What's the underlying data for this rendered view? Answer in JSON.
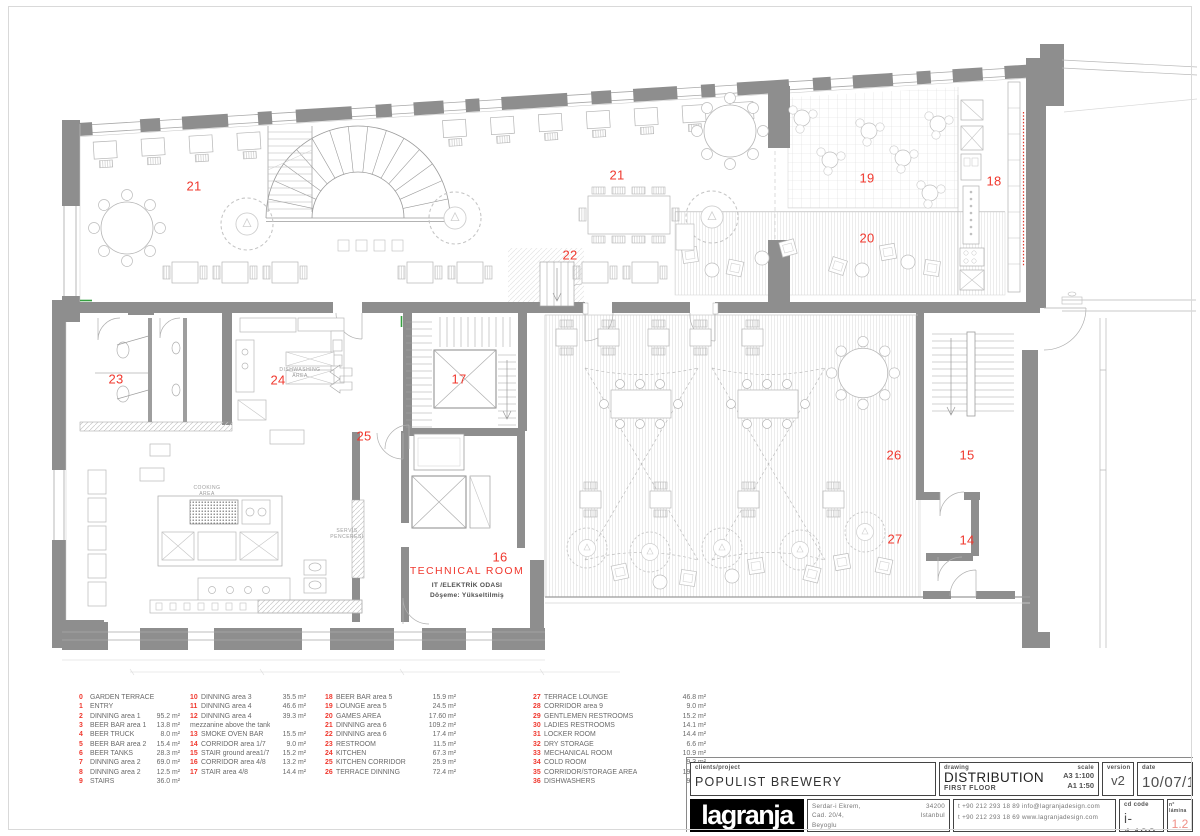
{
  "colors": {
    "accent_red": "#f0382e",
    "wall_gray": "#8e8e8e",
    "lamina_red": "#ef8f86"
  },
  "plan": {
    "labels": [
      {
        "n": "21",
        "x": 194,
        "y": 186
      },
      {
        "n": "21",
        "x": 617,
        "y": 175
      },
      {
        "n": "19",
        "x": 867,
        "y": 178
      },
      {
        "n": "18",
        "x": 994,
        "y": 181
      },
      {
        "n": "20",
        "x": 867,
        "y": 238
      },
      {
        "n": "22",
        "x": 570,
        "y": 255
      },
      {
        "n": "23",
        "x": 116,
        "y": 379
      },
      {
        "n": "24",
        "x": 278,
        "y": 380
      },
      {
        "n": "17",
        "x": 459,
        "y": 379
      },
      {
        "n": "25",
        "x": 364,
        "y": 436
      },
      {
        "n": "26",
        "x": 894,
        "y": 455
      },
      {
        "n": "15",
        "x": 967,
        "y": 455
      },
      {
        "n": "27",
        "x": 895,
        "y": 539
      },
      {
        "n": "14",
        "x": 967,
        "y": 540
      },
      {
        "n": "16",
        "x": 500,
        "y": 557
      }
    ],
    "area_texts": [
      {
        "t": "DISHWASHING",
        "x": 300,
        "y": 370
      },
      {
        "t": "AREA",
        "x": 300,
        "y": 376
      },
      {
        "t": "COOKING",
        "x": 207,
        "y": 488
      },
      {
        "t": "AREA",
        "x": 207,
        "y": 494
      },
      {
        "t": "SERVİS",
        "x": 347,
        "y": 531
      },
      {
        "t": "PENCERESİ",
        "x": 347,
        "y": 537
      }
    ],
    "technical_room": {
      "title": "TECHNICAL ROOM",
      "line1": "IT /ELEKTRİK ODASI",
      "line2": "Döşeme: Yükseltilmiş"
    }
  },
  "legend": {
    "columns": [
      {
        "x": 79,
        "width": 101,
        "items": [
          {
            "n": "0",
            "label": "GARDEN TERRACE",
            "area": ""
          },
          {
            "n": "1",
            "label": "ENTRY",
            "area": ""
          },
          {
            "n": "2",
            "label": "DINNING area 1",
            "area": "95.2 m²"
          },
          {
            "n": "3",
            "label": "BEER BAR area 1",
            "area": "13.8 m²"
          },
          {
            "n": "4",
            "label": "BEER TRUCK",
            "area": "8.0 m²"
          },
          {
            "n": "5",
            "label": "BEER BAR area 2",
            "area": "15.4 m²"
          },
          {
            "n": "6",
            "label": "BEER TANKS",
            "area": "28.3 m²"
          },
          {
            "n": "7",
            "label": "DINNING area 2",
            "area": "69.0 m²"
          },
          {
            "n": "8",
            "label": "DINNING area 2",
            "area": "12.5 m²"
          },
          {
            "n": "9",
            "label": "STAIRS",
            "area": "36.0 m²"
          }
        ]
      },
      {
        "x": 190,
        "width": 116,
        "items": [
          {
            "n": "10",
            "label": "DINNING area 3",
            "area": "35.5 m²"
          },
          {
            "n": "11",
            "label": "DINNING area 4",
            "area": "46.6 m²"
          },
          {
            "n": "12",
            "label": "DINNING area 4",
            "area": "39.3 m²"
          },
          {
            "n": "",
            "label": "mezzanine above the tank",
            "area": ""
          },
          {
            "n": "13",
            "label": "SMOKE OVEN BAR",
            "area": "15.5 m²"
          },
          {
            "n": "14",
            "label": "CORRIDOR area 1/7",
            "area": "9.0 m²"
          },
          {
            "n": "15",
            "label": "STAIR ground area1/7",
            "area": "15.2 m²"
          },
          {
            "n": "16",
            "label": "CORRIDOR area 4/8",
            "area": "13.2 m²"
          },
          {
            "n": "17",
            "label": "STAIR area 4/8",
            "area": "14.4 m²"
          }
        ]
      },
      {
        "x": 325,
        "width": 131,
        "items": [
          {
            "n": "18",
            "label": "BEER BAR area 5",
            "area": "15.9 m²"
          },
          {
            "n": "19",
            "label": "LOUNGE area 5",
            "area": "24.5 m²"
          },
          {
            "n": "20",
            "label": "GAMES AREA",
            "area": "17.60 m²"
          },
          {
            "n": "21",
            "label": "DINNING area 6",
            "area": "109.2 m²"
          },
          {
            "n": "22",
            "label": "DINNING area 6",
            "area": "17.4 m²"
          },
          {
            "n": "23",
            "label": "RESTROOM",
            "area": "11.5 m²"
          },
          {
            "n": "24",
            "label": "KITCHEN",
            "area": "67.3 m²"
          },
          {
            "n": "25",
            "label": "KITCHEN CORRIDOR",
            "area": "25.9 m²"
          },
          {
            "n": "26",
            "label": "TERRACE DINNING",
            "area": "72.4 m²"
          }
        ]
      },
      {
        "x": 533,
        "width": 173,
        "items": [
          {
            "n": "27",
            "label": "TERRACE LOUNGE",
            "area": "46.8 m²"
          },
          {
            "n": "28",
            "label": "CORRIDOR area 9",
            "area": "9.0 m²"
          },
          {
            "n": "29",
            "label": "GENTLEMEN RESTROOMS",
            "area": "15.2 m²"
          },
          {
            "n": "30",
            "label": "LADIES RESTROOMS",
            "area": "14.1 m²"
          },
          {
            "n": "31",
            "label": "LOCKER ROOM",
            "area": "14.4 m²"
          },
          {
            "n": "32",
            "label": "DRY STORAGE",
            "area": "6.6 m²"
          },
          {
            "n": "33",
            "label": "MECHANICAL ROOM",
            "area": "10.9 m²"
          },
          {
            "n": "34",
            "label": "COLD ROOM",
            "area": "9.3 m²"
          },
          {
            "n": "35",
            "label": "CORRIDOR/STORAGE AREA",
            "area": "19.9 m²"
          },
          {
            "n": "36",
            "label": "DISHWASHERS",
            "area": "9.5 m²"
          }
        ]
      }
    ]
  },
  "titleblock": {
    "clients_label": "clients/project",
    "client": "POPULIST BREWERY",
    "drawing_label": "drawing",
    "drawing": "DISTRIBUTION",
    "drawing_sub": "FIRST FLOOR",
    "scale_label": "scale",
    "scale1": "A3 1:100",
    "scale2": "A1 1:50",
    "version_label": "version",
    "version": "v2",
    "date_label": "date",
    "date": "10/07/15",
    "logo": "lagranja",
    "addr1": "Serdar-i Ekrem,",
    "addr2": "Cad. 20/4,",
    "addr3": "Beyoglu",
    "addr_zip": "34200",
    "addr_city": "Istanbul",
    "phone1": "t  +90 212 293 18 89  info@lagranjadesign.com",
    "phone2": "t  +90 212 293 18 69  www.lagranjadesign.com",
    "code_label": "cd code",
    "code": "i-1403",
    "lamina_label": "n° lámina",
    "lamina": "1.2"
  }
}
